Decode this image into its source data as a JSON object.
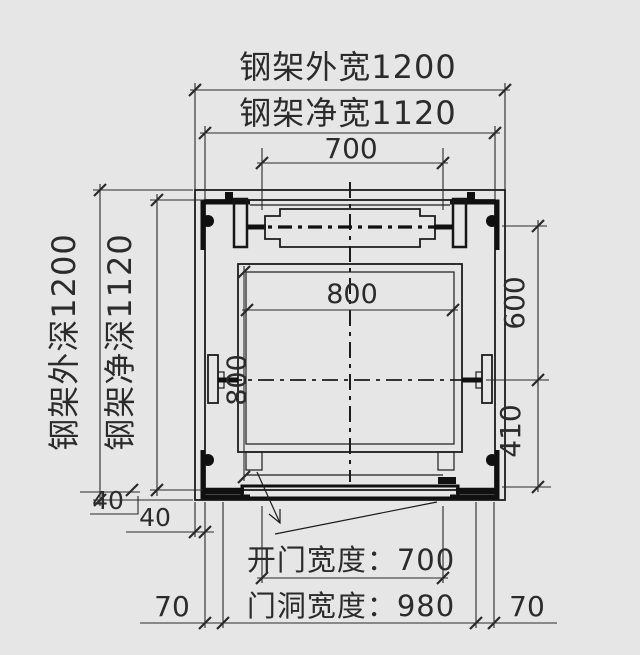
{
  "colors": {
    "background": "#e6e6e6",
    "line": "#1c1c1c",
    "text": "#2b2b2b"
  },
  "labels": {
    "outer_width": "钢架外宽1200",
    "net_width": "钢架净宽1120",
    "top_span": "700",
    "outer_depth": "钢架外深1200",
    "net_depth": "钢架净深1120",
    "car_width": "800",
    "car_depth": "800",
    "cw_to_center": "600",
    "center_to_front": "410",
    "offset_left_a": "40",
    "offset_left_b": "40",
    "door_opening": "开门宽度：700",
    "door_hole": "门洞宽度：980",
    "side_margin_left": "70",
    "side_margin_right": "70"
  }
}
